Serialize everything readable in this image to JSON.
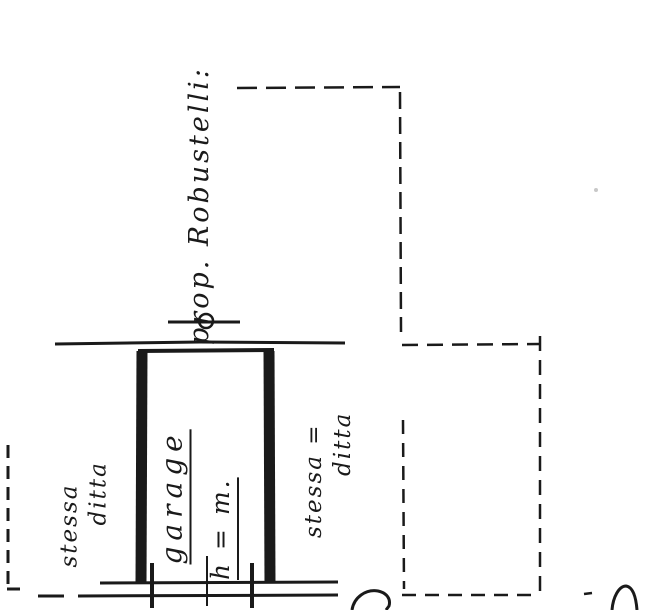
{
  "colors": {
    "ink": "#1a1a1a",
    "paper": "#ffffff",
    "artifact": "#c8c8c8"
  },
  "plan": {
    "owner_label": "prop. Robustelli:",
    "garage": {
      "name": "garage",
      "height_note": "h = m."
    },
    "left_neighbor": {
      "line1": "stessa",
      "line2": "ditta"
    },
    "right_neighbor": {
      "line1": "stessa =",
      "line2": "ditta"
    }
  }
}
